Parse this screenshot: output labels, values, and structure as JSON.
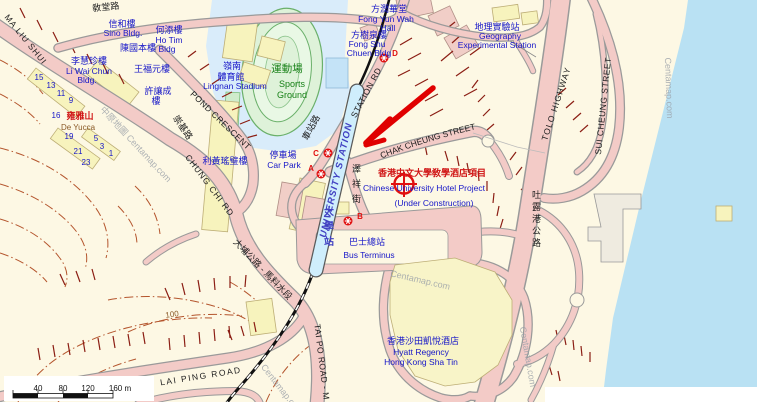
{
  "watermarks": {
    "full": "中原地圖 Centamap.com",
    "short": "Centamap.com"
  },
  "scalebar": {
    "t1": "40",
    "t2": "80",
    "t3": "120",
    "t4": "160 m"
  },
  "contour": {
    "elev": "100"
  },
  "roads": {
    "ma_liu_shui": "MA LIU SHUI",
    "church_rd_zh": "敎堂路",
    "station_rd": "STATION RD",
    "station_rd_zh": "車站路",
    "pond_crescent": "POND CRESCENT",
    "chung_chi_rd": "CHUNG CHI RD",
    "chung_chi_rd_zh": "崇基路",
    "chak_cheung_st": "CHAK CHEUNG STREET",
    "chak_cheung_st_zh": "澤祥街",
    "tolo_highway": "TOLO HIGHWAY",
    "tolo_highway_zh": "吐露港公路",
    "sui_cheung_st": "SUI CHEUNG STREET",
    "lai_ping_road": "LAI PING ROAD",
    "tai_po_road": "TAI PO ROAD - M",
    "tai_po_road_zh": "大埔公路 - 馬料水段"
  },
  "station": {
    "name": "UNIVERSITY STATION",
    "name_zh": "大學站",
    "exit_a": "A",
    "exit_b": "B",
    "exit_c": "C",
    "exit_d": "D"
  },
  "annotation": {
    "zh": "香港中文大學敎學酒店項目",
    "en": "Chinese University Hotel Project",
    "status": "(Under Construction)"
  },
  "places": {
    "sino_zh": "信和樓",
    "sino_en": "Sino Bldg.",
    "hotim_zh": "何添樓",
    "hotim_en1": "Ho Tim",
    "hotim_en2": "Bldg",
    "chankwokpun_zh": "陳國本樓",
    "liwaichun_zh": "李慧珍樓",
    "liwaichun_en1": "Li Wai Chun",
    "liwaichun_en2": "Bldg.",
    "wongfukyuen_zh": "王福元樓",
    "huiyeungshing_zh1": "許讓成",
    "huiyeungshing_zh2": "樓",
    "lingnan_zh1": "嶺南",
    "lingnan_zh2": "體育館",
    "lingnan_en": "Lingnan Stadium",
    "sports_zh": "運動場",
    "sports_en1": "Sports",
    "sports_en2": "Ground",
    "fongyunwah_zh": "方潤華堂",
    "fongyunwah_en1": "Fong Yun Wah",
    "fongyunwah_en2": "Hall",
    "fongshuchuen_zh": "方樹泉樓",
    "fongshuchuen_en1": "Fong Shu",
    "fongshuchuen_en2": "Chuen Bldg",
    "geo_zh": "地理實驗站",
    "geo_en1": "Geography",
    "geo_en2": "Experimental Station",
    "carpark_zh": "停車場",
    "carpark_en": "Car Park",
    "leewong_zh": "利黃瑤璧樓",
    "yucca_no": "16",
    "yucca_zh": "雍雅山",
    "yucca_en": "De Yucca",
    "bus_zh": "巴士總站",
    "bus_en": "Bus Terminus",
    "hyatt_zh": "香港沙田凱悅酒店",
    "hyatt_en1": "Hyatt Regency",
    "hyatt_en2": "Hong Kong Sha Tin"
  },
  "house_numbers": {
    "n15": "15",
    "n13": "13",
    "n11": "11",
    "n9": "9",
    "n19": "19",
    "n5": "5",
    "n21": "21",
    "n3": "3",
    "n1": "1",
    "n23": "23"
  }
}
